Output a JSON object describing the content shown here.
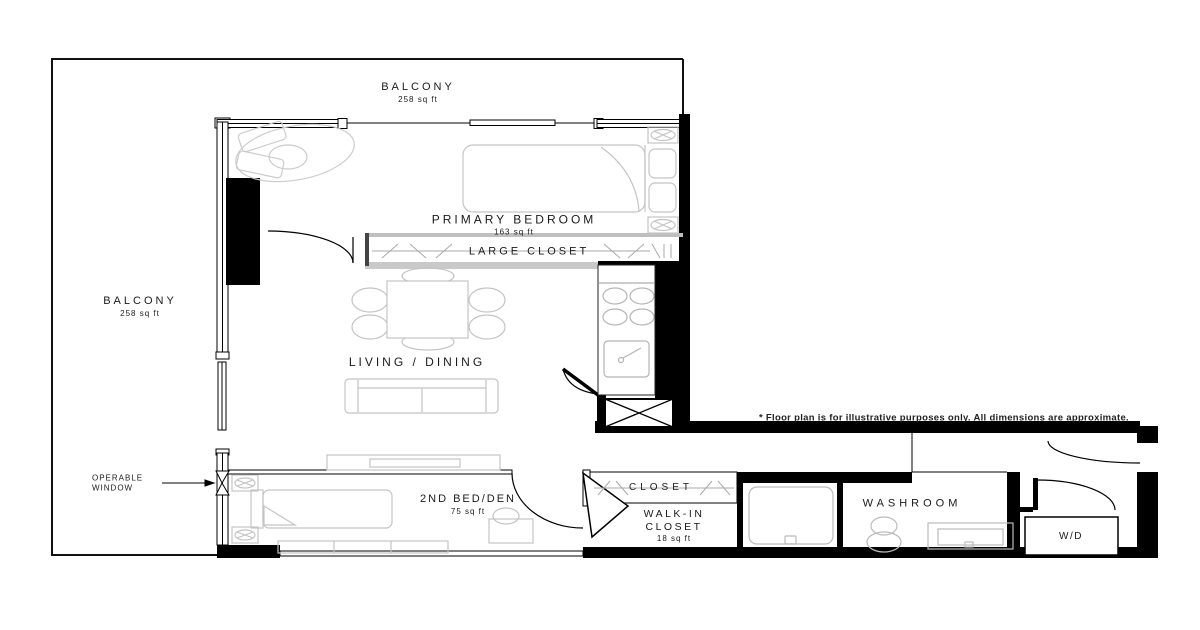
{
  "labels": {
    "balcony_top": {
      "name": "BALCONY",
      "area": "258 sq ft"
    },
    "balcony_left": {
      "name": "BALCONY",
      "area": "258 sq ft"
    },
    "primary_bedroom": {
      "name": "PRIMARY BEDROOM",
      "area": "163 sq ft"
    },
    "large_closet": {
      "name": "LARGE CLOSET"
    },
    "living_dining": {
      "name": "LIVING / DINING"
    },
    "second_bed_den": {
      "name": "2ND BED/DEN",
      "area": "75 sq ft"
    },
    "closet": {
      "name": "CLOSET"
    },
    "walk_in_closet": {
      "line1": "WALK-IN",
      "line2": "CLOSET",
      "area": "18 sq ft"
    },
    "washroom": {
      "name": "WASHROOM"
    },
    "washer_dryer": {
      "name": "W/D"
    },
    "operable_window": {
      "line1": "OPERABLE",
      "line2": "WINDOW"
    }
  },
  "disclaimer": "* Floor plan is for illustrative purposes only. All dimensions are approximate.",
  "colors": {
    "wall": "#000000",
    "furniture_line": "#c4c4c4",
    "gray_wall": "#c9c9c9",
    "text": "#1a1a1a",
    "background": "#ffffff"
  }
}
